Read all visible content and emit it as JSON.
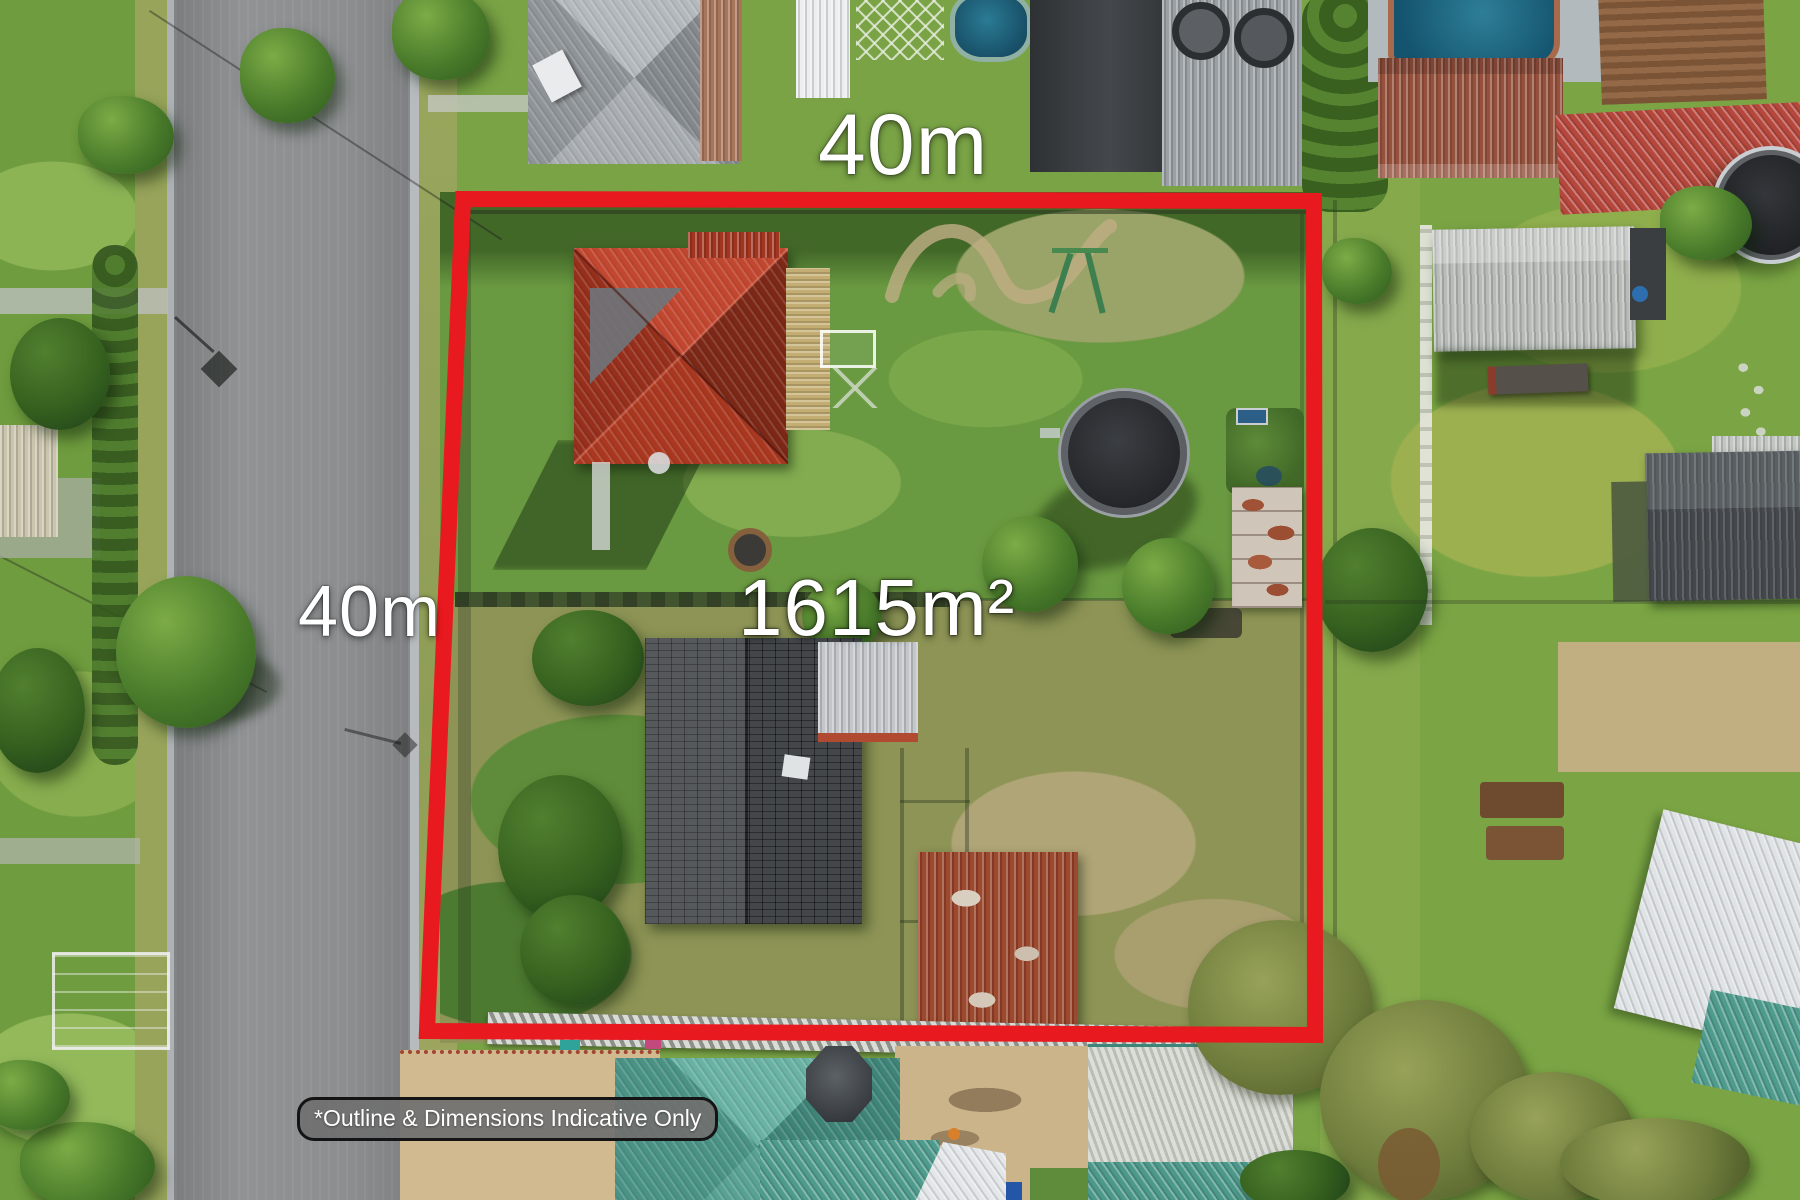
{
  "photo": {
    "type": "aerial-property-listing-photo",
    "labels": {
      "top_dimension": "40m",
      "left_dimension": "40m",
      "area": "1615m²",
      "disclaimer": "*Outline & Dimensions Indicative Only"
    },
    "colors": {
      "outline_red": "#e8191f",
      "label_text": "#ffffff",
      "disclaimer_background": "#707070",
      "disclaimer_border": "#141414"
    }
  }
}
